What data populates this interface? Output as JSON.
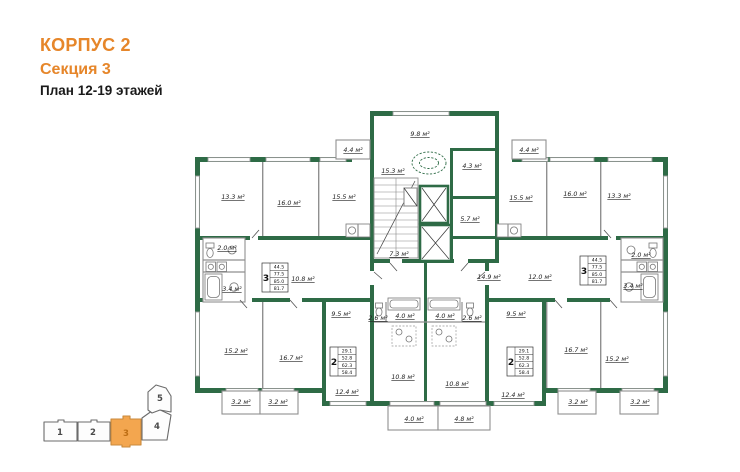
{
  "header": {
    "building": "КОРПУС 2",
    "section": "Секция 3",
    "floors": "План 12-19 этажей"
  },
  "colors": {
    "accent_orange": "#E6862A",
    "wall_green": "#2E6B46",
    "locator_active_fill": "#F3A64F"
  },
  "plan": {
    "units": "м²",
    "areas": {
      "a13_3": "13.3 м²",
      "a16_0": "16.0 м²",
      "a15_5": "15.5 м²",
      "a4_4": "4.4 м²",
      "a15_3": "15.3 м²",
      "a9_8": "9.8 м²",
      "a4_3": "4.3 м²",
      "a5_7": "5.7 м²",
      "a7_3": "7.3 м²",
      "a14_9": "14.9 м²",
      "a2_0": "2.0 м²",
      "a3_4": "3.4 м²",
      "a10_8": "10.8 м²",
      "a12_0": "12.0 м²",
      "a15_2": "15.2 м²",
      "a16_7": "16.7 м²",
      "a9_5": "9.5 м²",
      "a12_4": "12.4 м²",
      "a3_2": "3.2 м²",
      "a2_6": "2.6 м²",
      "a4_0": "4.0 м²",
      "a4_8": "4.8 м²"
    },
    "stamps": {
      "three_room": {
        "rooms": "3",
        "values": [
          "44.5",
          "77.5",
          "85.0",
          "81.7"
        ]
      },
      "two_room": {
        "rooms": "2",
        "values": [
          "29.1",
          "52.8",
          "62.3",
          "58.4"
        ]
      }
    }
  },
  "locator": {
    "sections": [
      "1",
      "2",
      "3",
      "4",
      "5"
    ],
    "active": "3"
  }
}
